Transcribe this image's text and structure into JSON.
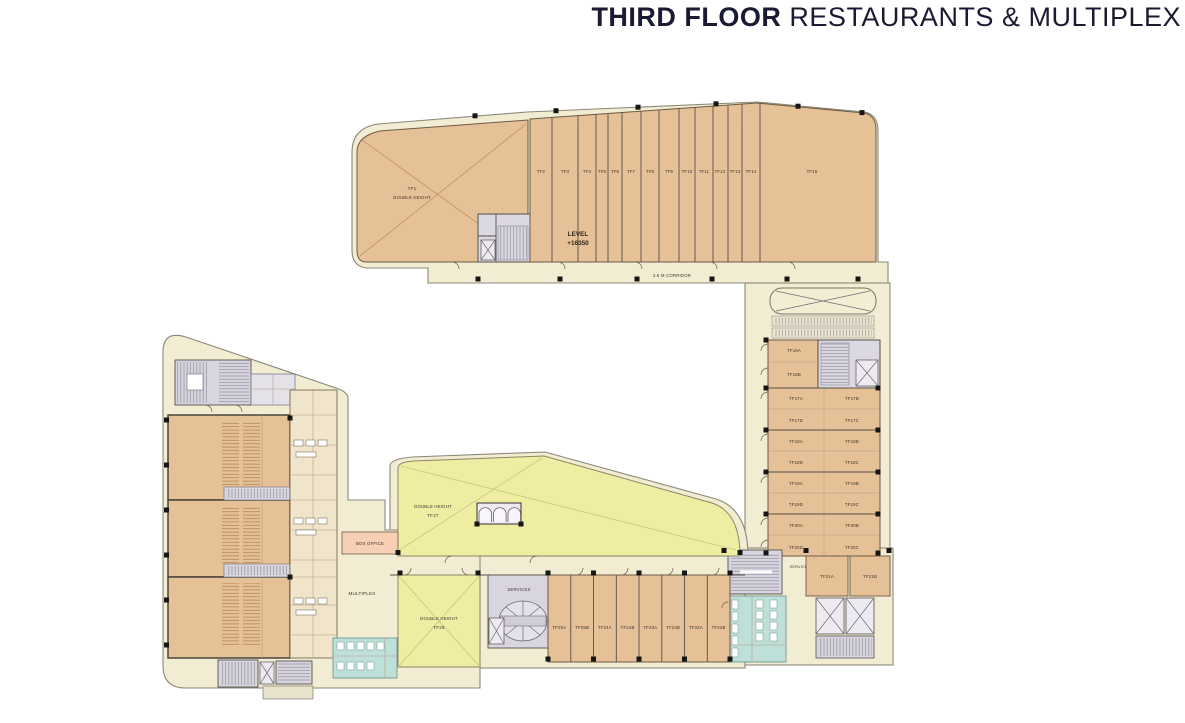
{
  "title": {
    "bold": "THIRD FLOOR",
    "rest": " RESTAURANTS & MULTIPLEX"
  },
  "colors": {
    "corridor_cream": "#F2ECD2",
    "unit_tan": "#E6C096",
    "double_height_yellow": "#EFEDA2",
    "services_grey": "#D8D5E0",
    "toilet_teal": "#BFE0D8",
    "box_office_pink": "#F6CFB5",
    "column_black": "#161616",
    "title_navy": "#1A1A33"
  },
  "top_band": {
    "tf1": {
      "id": "TF1",
      "note": "DOUBLE HEIGHT"
    },
    "level": {
      "line1": "LEVEL",
      "line2": "+16350"
    },
    "corridor": "3.6 M CORRIDOR",
    "units": [
      "TF2",
      "TF3",
      "TF4",
      "TF5",
      "TF6",
      "TF7",
      "TF8",
      "TF9",
      "TF10",
      "TF11",
      "TF12",
      "TF13",
      "TF14",
      "TF15"
    ]
  },
  "right_wing": {
    "rows": [
      {
        "left": "TF16A"
      },
      {
        "left": "TF16B"
      },
      {
        "left": "TF17A",
        "right": "TF17B"
      },
      {
        "left": "TF17D",
        "right": "TF17C"
      },
      {
        "left": "TF18A",
        "right": "TF18B"
      },
      {
        "left": "TF18D",
        "right": "TF18C"
      },
      {
        "left": "TF19A",
        "right": "TF19B"
      },
      {
        "left": "TF19D",
        "right": "TF19C"
      },
      {
        "left": "TF20A",
        "right": "TF20B"
      },
      {
        "left": "TF20D",
        "right": "TF20C"
      }
    ]
  },
  "right_services": {
    "label": "SERVICES",
    "units": [
      "TF21A",
      "TF21B"
    ]
  },
  "center": {
    "tf27": {
      "note": "DOUBLE HEIGHT",
      "id": "TF27"
    },
    "tf26": {
      "note": "DOUBLE HEIGHT",
      "id": "TF26"
    },
    "box_office": "BOX OFFICE",
    "multiplex": "MULTIPLEX",
    "services": "SERVICES"
  },
  "bottom_row": {
    "units": [
      "TF25A",
      "TF25B",
      "TF24A",
      "TF24B",
      "TF23A",
      "TF23B",
      "TF22A",
      "TF22B"
    ]
  }
}
